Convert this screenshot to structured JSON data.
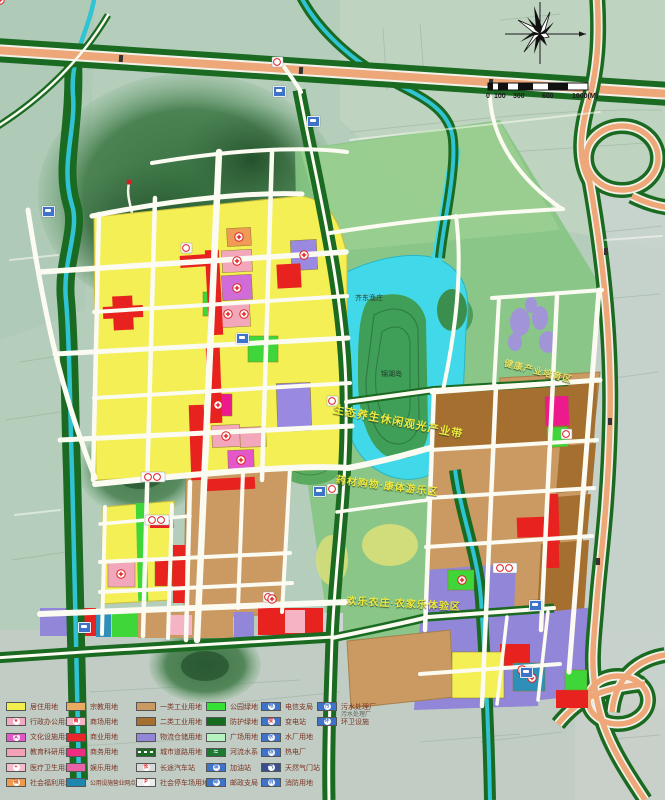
{
  "title": "城市用地规划图",
  "palette": {
    "residential_yellow": "#f3ef55",
    "commercial_red": "#e8231f",
    "industry_class1_tan": "#cb9a62",
    "industry_class2_brown": "#a5702f",
    "logistics_purple": "#9186d8",
    "park_green": "#35e135",
    "protective_green": "#1a6a21",
    "water_cyan": "#41d9e9",
    "highway_salmon": "#eda778",
    "poi_blue": "#3f72c9",
    "map_base": "#b4cebb"
  },
  "map": {
    "labels": [
      {
        "text": "齐东渔庄",
        "x": 355,
        "y": 293,
        "size": 7,
        "color": "#2c3a30",
        "rot": 0,
        "plain": true
      },
      {
        "text": "锦湖岛",
        "x": 381,
        "y": 369,
        "size": 7,
        "color": "#1e3b28",
        "rot": 0,
        "plain": true
      },
      {
        "text": "生态养生休闲观光产业带",
        "x": 335,
        "y": 401,
        "size": 11,
        "color": "#f0ea3e",
        "rot": 11
      },
      {
        "text": "药材购物·康体游乐区",
        "x": 337,
        "y": 471,
        "size": 10,
        "color": "#f0ea3e",
        "rot": 7
      },
      {
        "text": "欢乐农庄·农家乐体验区",
        "x": 347,
        "y": 592,
        "size": 10,
        "color": "#f0ea3e",
        "rot": 3
      },
      {
        "text": "健康产业培育区",
        "x": 506,
        "y": 356,
        "size": 9,
        "color": "#e8e568",
        "rot": 14
      },
      {
        "text": "污水处理厂",
        "x": 341,
        "y": 709,
        "size": 6,
        "color": "#5a6258",
        "rot": 0,
        "plain": true
      }
    ],
    "pois": [
      {
        "x": 273,
        "y": 86
      },
      {
        "x": 307,
        "y": 116
      },
      {
        "x": 42,
        "y": 206
      },
      {
        "x": 236,
        "y": 333
      },
      {
        "x": 313,
        "y": 486
      },
      {
        "x": 78,
        "y": 622
      },
      {
        "x": 529,
        "y": 600
      },
      {
        "x": 520,
        "y": 667
      }
    ]
  },
  "scalebar": {
    "ticks": [
      {
        "t": "0",
        "x": 486
      },
      {
        "t": "100",
        "x": 494
      },
      {
        "t": "300",
        "x": 513
      },
      {
        "t": "600",
        "x": 542
      },
      {
        "t": "1000(M)",
        "x": 572
      }
    ]
  },
  "legend": {
    "columns": [
      {
        "x": 6,
        "items": [
          {
            "label": "居住用地",
            "swatch": "color",
            "color": "#f2ee4e"
          },
          {
            "label": "行政办公用地",
            "swatch": "icon",
            "color": "#f3a8c4",
            "glyph": "★",
            "glyphColor": "#e02020"
          },
          {
            "label": "文化设施用地",
            "swatch": "icon",
            "color": "#e357cb",
            "glyph": "文",
            "glyphColor": "#c02090"
          },
          {
            "label": "教育科研用地",
            "swatch": "color",
            "color": "#f2a2b4"
          },
          {
            "label": "医疗卫生用地",
            "swatch": "icon",
            "color": "#f5bccd",
            "glyph": "+",
            "glyphColor": "#e02020"
          },
          {
            "label": "社会福利用地",
            "swatch": "icon",
            "color": "#f09a4e",
            "glyph": "福",
            "glyphColor": "#d05510"
          }
        ]
      },
      {
        "x": 66,
        "items": [
          {
            "label": "宗教用地",
            "swatch": "color",
            "color": "#e9ab62"
          },
          {
            "label": "商场用地",
            "swatch": "icon",
            "color": "#f5b4c4",
            "glyph": "商",
            "glyphColor": "#e02020"
          },
          {
            "label": "商业用地",
            "swatch": "color",
            "color": "#e8262c"
          },
          {
            "label": "商务用地",
            "swatch": "color",
            "color": "#ee2d80"
          },
          {
            "label": "娱乐用地",
            "swatch": "color",
            "color": "#e763a8"
          },
          {
            "label": "公用设施营业网点用地",
            "swatch": "color",
            "color": "#1f86ad",
            "small": true
          }
        ]
      },
      {
        "x": 136,
        "items": [
          {
            "label": "一类工业用地",
            "swatch": "color",
            "color": "#cb9a62"
          },
          {
            "label": "二类工业用地",
            "swatch": "color",
            "color": "#a5702f"
          },
          {
            "label": "物流仓储用地",
            "swatch": "color",
            "color": "#9186d8"
          },
          {
            "label": "城市道路用地",
            "swatch": "road",
            "color": "#1c6b22"
          },
          {
            "label": "长途汽车站",
            "swatch": "icon",
            "color": "#d9d9d9",
            "glyph": "长",
            "glyphColor": "#e02020"
          },
          {
            "label": "社会停车场用地",
            "swatch": "icon",
            "color": "#ececec",
            "glyph": "P",
            "glyphColor": "#e02020"
          }
        ]
      },
      {
        "x": 206,
        "items": [
          {
            "label": "公园绿地",
            "swatch": "color",
            "color": "#35e135"
          },
          {
            "label": "防护绿地",
            "swatch": "color",
            "color": "#156b1d"
          },
          {
            "label": "广场用地",
            "swatch": "color",
            "color": "#b6f2c0"
          },
          {
            "label": "河流水系",
            "swatch": "river",
            "color": "#1c7a2e"
          },
          {
            "label": "加油站",
            "swatch": "icon",
            "color": "#3f72c9",
            "glyph": "油",
            "glyphColor": "#3f72c9"
          },
          {
            "label": "邮政支局",
            "swatch": "icon",
            "color": "#3f72c9",
            "glyph": "邮",
            "glyphColor": "#3f72c9"
          }
        ]
      },
      {
        "x": 261,
        "items": [
          {
            "label": "电信支局",
            "swatch": "icon",
            "color": "#3f72c9",
            "glyph": "电",
            "glyphColor": "#3f72c9"
          },
          {
            "label": "变电站",
            "swatch": "icon",
            "color": "#3f72c9",
            "glyph": "变",
            "glyphColor": "#e03030"
          },
          {
            "label": "水厂用地",
            "swatch": "icon",
            "color": "#3f72c9",
            "glyph": "水",
            "glyphColor": "#3f72c9"
          },
          {
            "label": "热电厂",
            "swatch": "icon",
            "color": "#3f72c9",
            "glyph": "热",
            "glyphColor": "#3f72c9"
          },
          {
            "label": "天然气门站",
            "swatch": "icon",
            "color": "#39508e",
            "glyph": "气",
            "glyphColor": "#39508e"
          },
          {
            "label": "消防用地",
            "swatch": "icon",
            "color": "#3f72c9",
            "glyph": "消",
            "glyphColor": "#3f72c9"
          }
        ]
      },
      {
        "x": 317,
        "items": [
          {
            "label": "污水处理厂",
            "swatch": "icon",
            "color": "#3f72c9",
            "glyph": "污",
            "glyphColor": "#3f72c9"
          },
          {
            "label": "环卫设施",
            "swatch": "icon",
            "color": "#3f72c9",
            "glyph": "环",
            "glyphColor": "#3f72c9"
          }
        ]
      }
    ]
  }
}
